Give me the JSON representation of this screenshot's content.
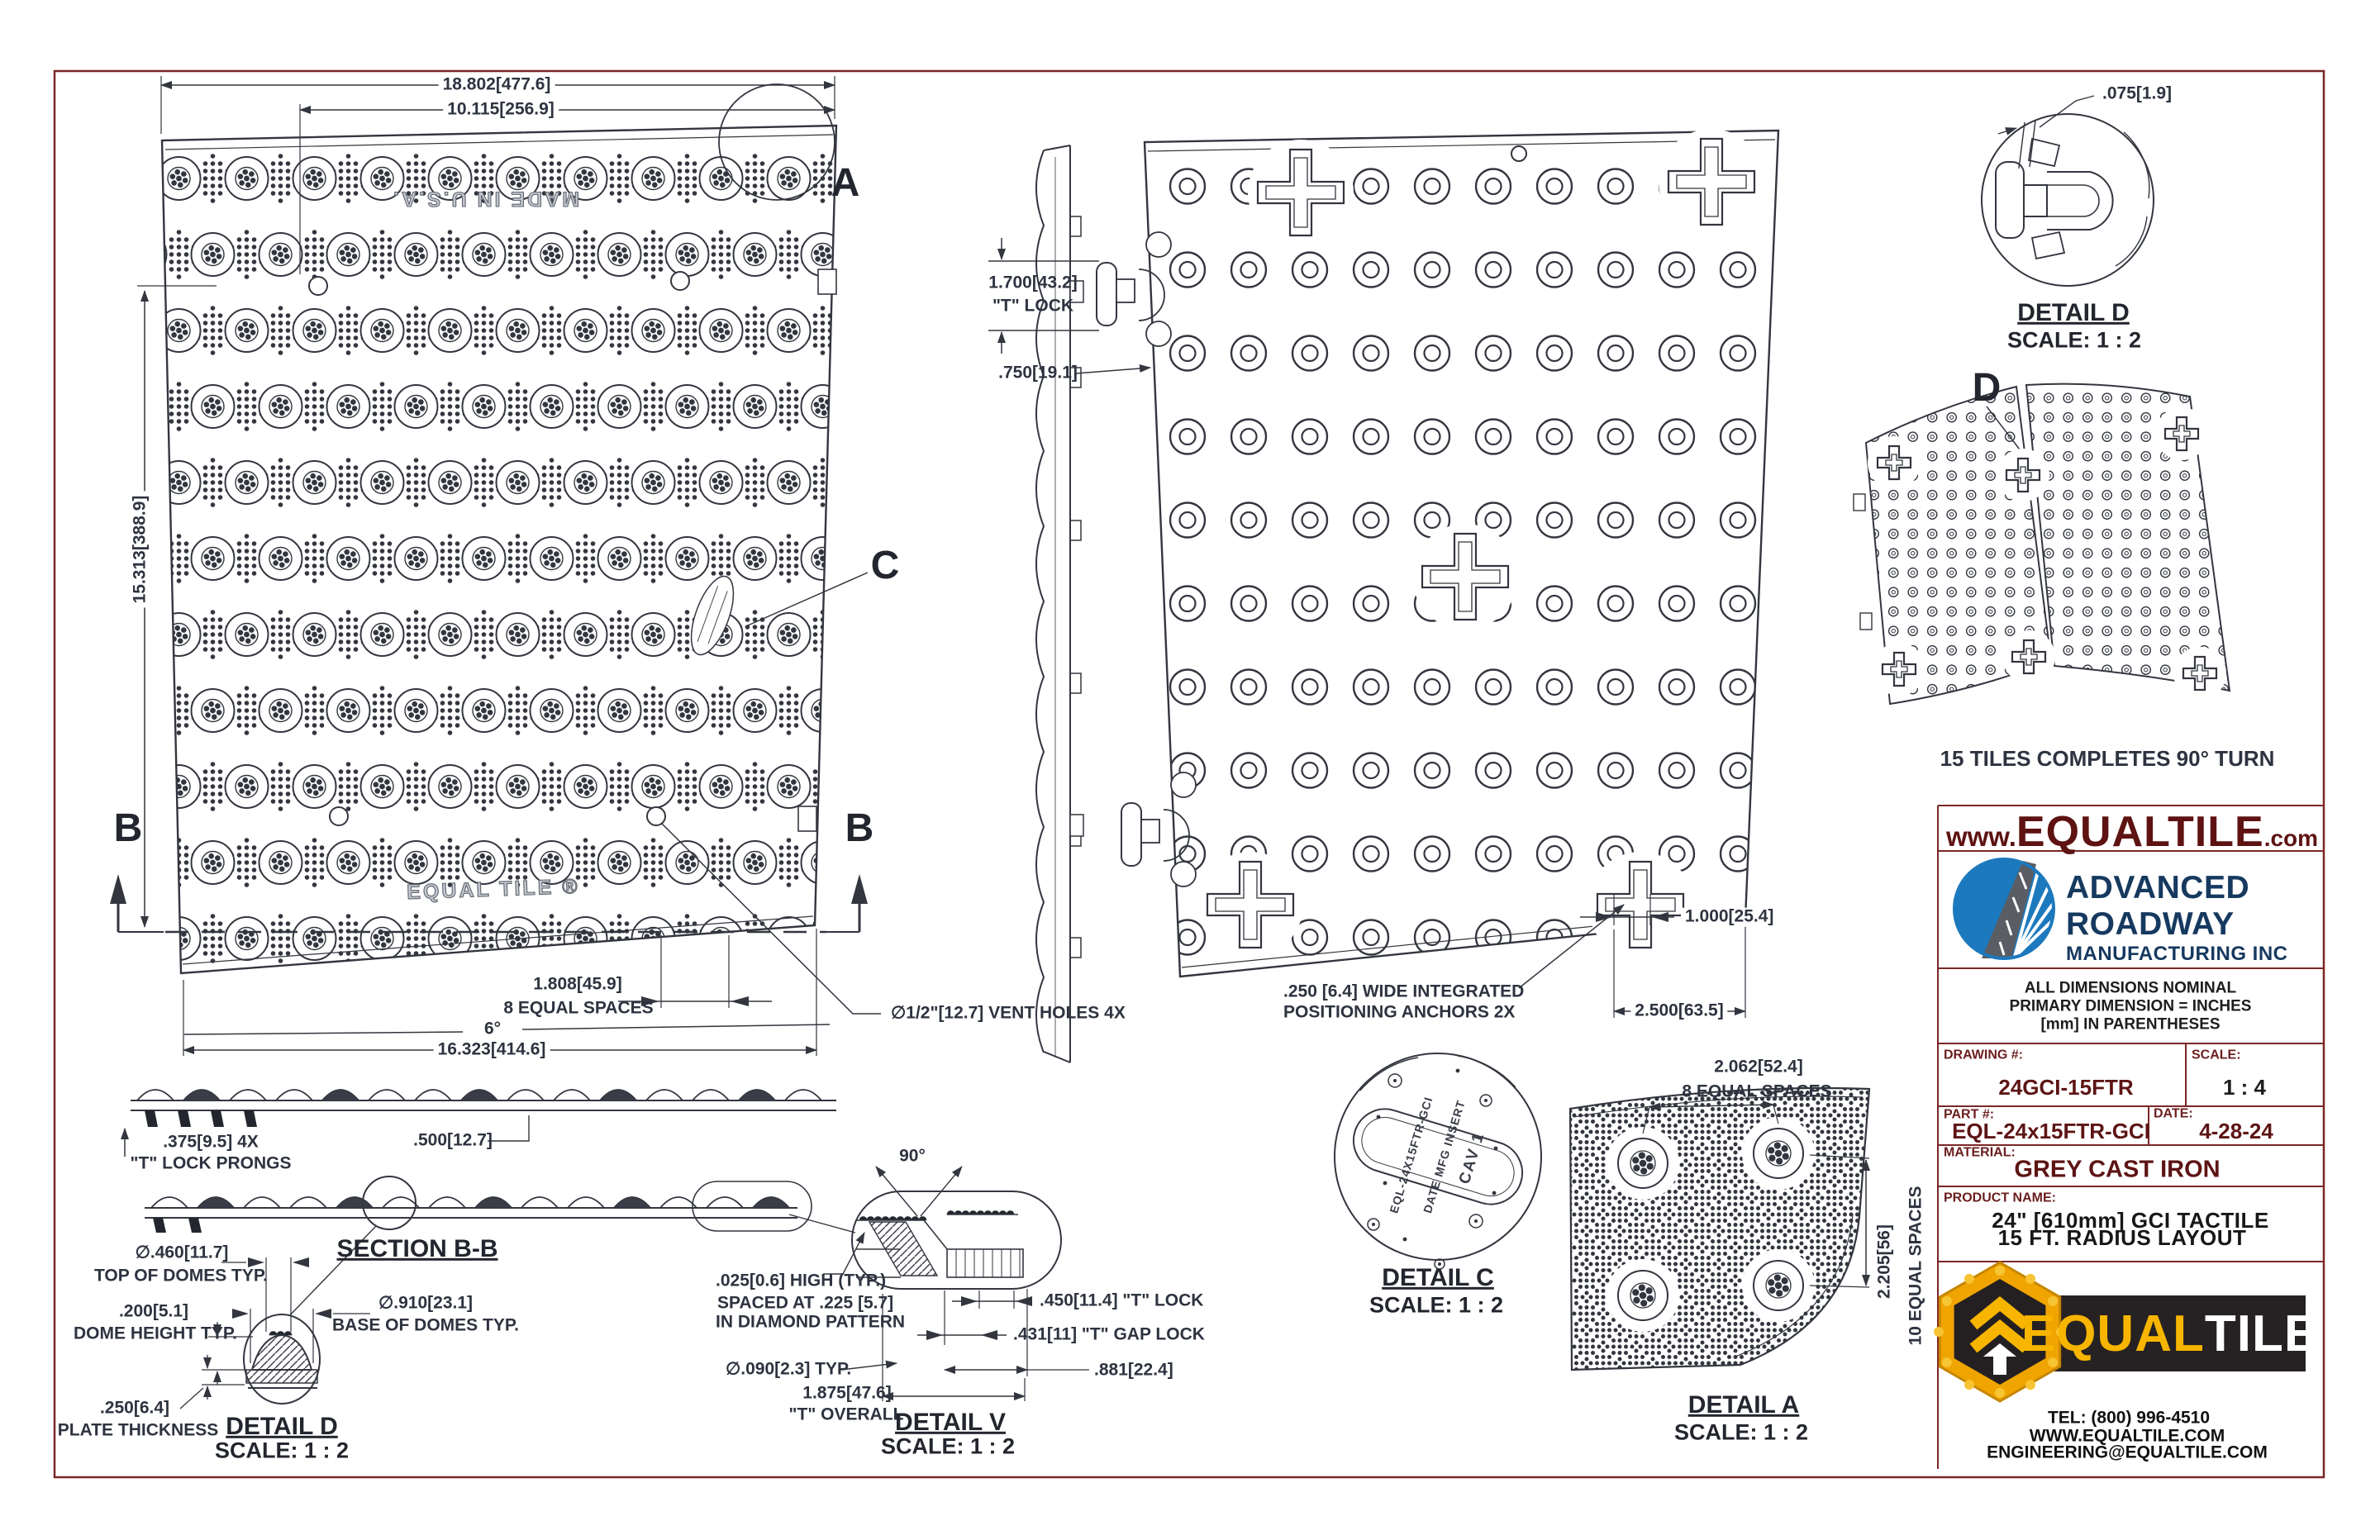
{
  "colors": {
    "ink": "#33363f",
    "maroon": "#7b2626",
    "logo_blue": "#1d79bd",
    "navy": "#16395f",
    "gold": "#f7b500",
    "black_banner": "#262122"
  },
  "main_view": {
    "dim_overall_top": "18.802[477.6]",
    "dim_partial_top": "10.115[256.9]",
    "dim_height": "15.313[388.9]",
    "dim_space": "1.808[45.9]",
    "dim_space_note": "8 EQUAL SPACES",
    "dim_angle": "6°",
    "dim_overall_bottom": "16.323[414.6]",
    "vent_note": "∅1/2\"[12.7] VENT HOLES 4X",
    "embossed_top": "MADE IN U.S.A.",
    "embossed_bottom": "EQUAL TILE ®"
  },
  "callouts": {
    "a": "A",
    "b": "B",
    "c": "C",
    "d": "D"
  },
  "side_view": {
    "dim_tlock": "1.700[43.2]",
    "tlock_label": "\"T\" LOCK",
    "dim_depth": ".750[19.1]"
  },
  "back_view": {
    "anchor_note_line1": ".250 [6.4] WIDE INTEGRATED",
    "anchor_note_line2": "POSITIONING ANCHORS 2X",
    "dim_anchor_width": "1.000[25.4]",
    "dim_anchor_offset": "2.500[63.5]"
  },
  "detail_d_top": {
    "dim_gap": ".075[1.9]",
    "title": "DETAIL D",
    "scale": "SCALE: 1 : 2"
  },
  "radius_layout": {
    "note": "15 TILES COMPLETES 90° TURN"
  },
  "section_bb": {
    "dim_prongs": ".375[9.5] 4X",
    "prongs_label": "\"T\" LOCK PRONGS",
    "dim_500": ".500[12.7]",
    "title": "SECTION B-B"
  },
  "detail_d_bottom": {
    "dim_top_domes": "∅.460[11.7]",
    "top_domes_label": "TOP OF DOMES TYP.",
    "dim_dome_height": ".200[5.1]",
    "dome_height_label": "DOME HEIGHT TYP.",
    "dim_base_domes": "∅.910[23.1]",
    "base_domes_label": "BASE OF DOMES TYP.",
    "dim_plate": ".250[6.4]",
    "plate_label": "PLATE THICKNESS",
    "title": "DETAIL D",
    "scale": "SCALE: 1 : 2"
  },
  "detail_v": {
    "dim_angle": "90°",
    "note_line1": ".025[0.6] HIGH (TYP.)",
    "note_line2": "SPACED AT .225 [5.7]",
    "note_line3": "IN DIAMOND PATTERN",
    "dim_tlock": ".450[11.4] \"T\" LOCK",
    "dim_gap": ".431[11] \"T\" GAP LOCK",
    "dim_diam": "∅.090[2.3] TYP.",
    "dim_overall": "1.875[47.6]",
    "overall_label": "\"T\" OVERALL",
    "dim_881": ".881[22.4]",
    "title": "DETAIL V",
    "scale": "SCALE: 1 : 2"
  },
  "detail_c": {
    "title": "DETAIL C",
    "scale": "SCALE: 1 : 2",
    "stamp_part": "EQL-24X15FTR-GCI",
    "stamp_date": "DATE MFG INSERT",
    "stamp_cav": "CAV 1"
  },
  "detail_a": {
    "dim_spacing": "2.062[52.4]",
    "spacing_label": "8 EQUAL SPACES",
    "dim_vert": "2.205[56]",
    "vert_label": "10 EQUAL SPACES",
    "title": "DETAIL A",
    "scale": "SCALE: 1 : 2"
  },
  "title_block": {
    "website_pre": "www.",
    "website_brand": "EQUALTILE",
    "website_tld": ".com",
    "company_line1": "ADVANCED",
    "company_line2": "ROADWAY",
    "company_line3": "MANUFACTURING INC",
    "note1": "ALL DIMENSIONS NOMINAL",
    "note2": "PRIMARY DIMENSION = INCHES",
    "note3": "[mm] IN PARENTHESES",
    "drawing_label": "DRAWING #:",
    "drawing_value": "24GCI-15FTR",
    "scale_label": "SCALE:",
    "scale_value": "1 : 4",
    "part_label": "PART #:",
    "part_value": "EQL-24x15FTR-GCI",
    "date_label": "DATE:",
    "date_value": "4-28-24",
    "material_label": "MATERIAL:",
    "material_value": "GREY CAST IRON",
    "product_label": "PRODUCT NAME:",
    "product_line1": "24\" [610mm] GCI TACTILE",
    "product_line2": "15 FT. RADIUS LAYOUT",
    "logo_equal": "EQUAL",
    "logo_tile": "TILE",
    "tel": "TEL: (800) 996-4510",
    "web": "WWW.EQUALTILE.COM",
    "email": "ENGINEERING@EQUALTILE.COM"
  }
}
